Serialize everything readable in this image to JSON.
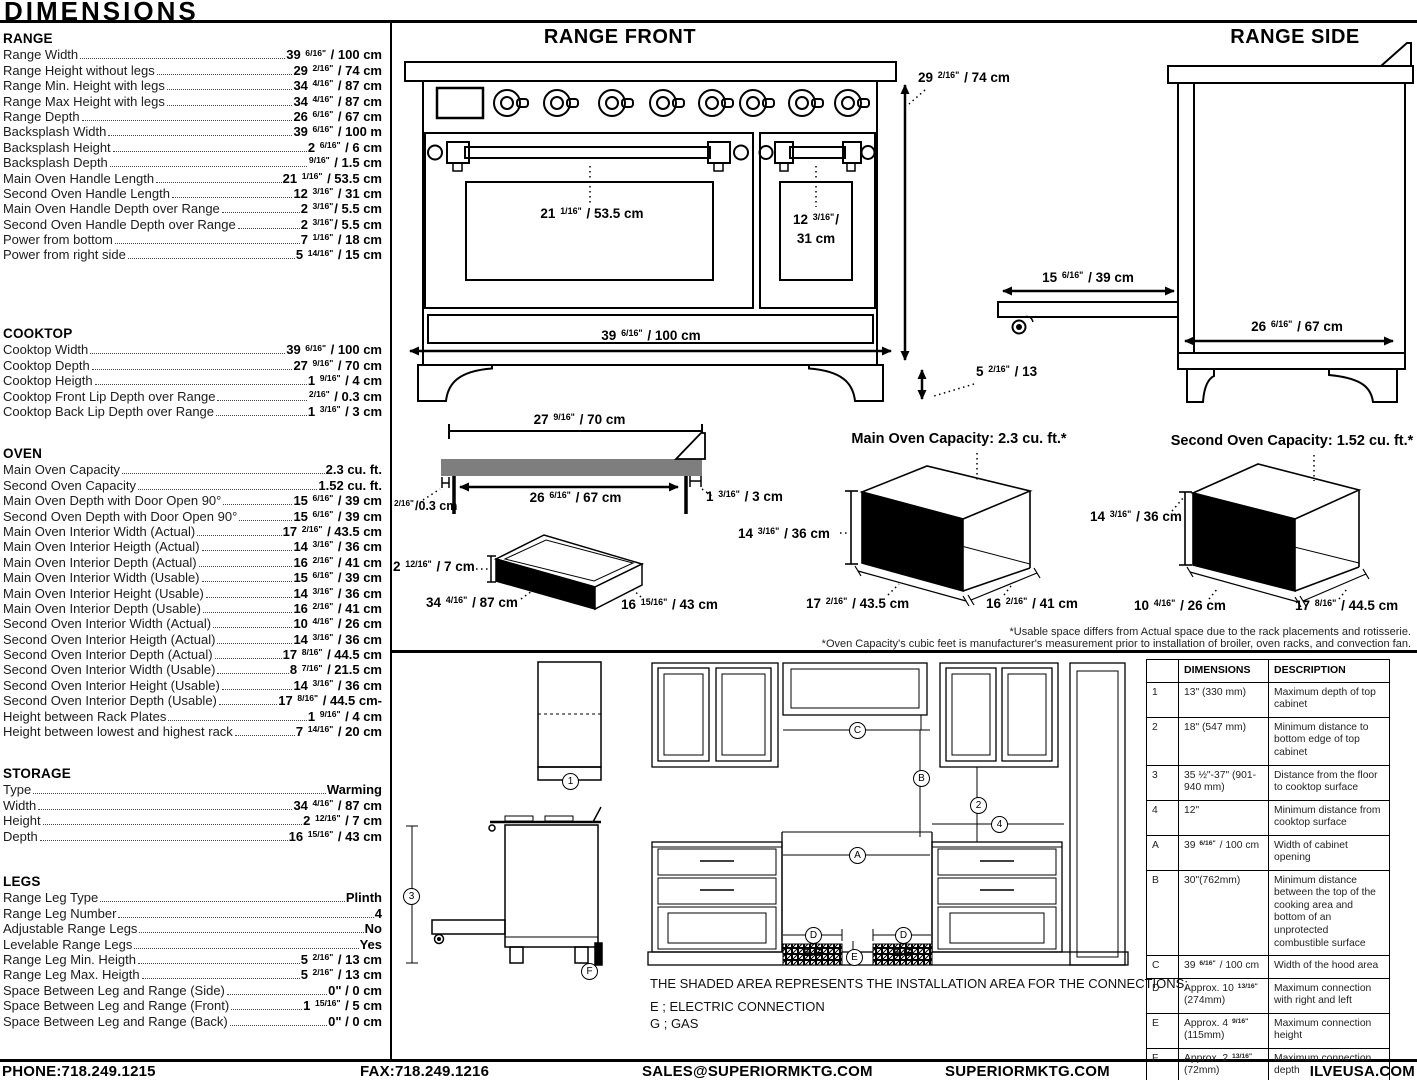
{
  "page": {
    "title": "DIMENSIONS"
  },
  "specs": [
    {
      "title": "RANGE",
      "items": [
        {
          "label": "Range Width",
          "value": "39 6/16\" / 100 cm"
        },
        {
          "label": "Range Height without legs",
          "value": "29 2/16\" / 74 cm"
        },
        {
          "label": "Range Min. Height with legs",
          "value": "34 4/16\" / 87 cm"
        },
        {
          "label": "Range Max Height with legs",
          "value": "34 4/16\" / 87 cm"
        },
        {
          "label": "Range Depth",
          "value": "26 6/16\" / 67 cm"
        },
        {
          "label": "Backsplash Width",
          "value": "39 6/16\" / 100 m"
        },
        {
          "label": "Backsplash Height",
          "value": "2 6/16\" / 6 cm"
        },
        {
          "label": "Backsplash Depth",
          "value": "9/16\" / 1.5 cm"
        },
        {
          "label": "Main Oven Handle Length",
          "value": "21 1/16\" / 53.5 cm"
        },
        {
          "label": "Second Oven Handle Length",
          "value": "12 3/16\" / 31 cm"
        },
        {
          "label": "Main Oven Handle Depth over Range",
          "value": "2 3/16\"/ 5.5 cm"
        },
        {
          "label": "Second Oven Handle Depth over Range",
          "value": "2 3/16\"/ 5.5 cm"
        },
        {
          "label": "Power from bottom",
          "value": "7 1/16\" / 18 cm"
        },
        {
          "label": "Power from right side",
          "value": "5 14/16\" / 15 cm"
        }
      ]
    },
    {
      "title": "COOKTOP",
      "items": [
        {
          "label": "Cooktop Width",
          "value": "39 6/16\" / 100 cm"
        },
        {
          "label": "Cooktop Depth",
          "value": "27 9/16\" / 70 cm"
        },
        {
          "label": "Cooktop Heigth",
          "value": "1 9/16\" / 4 cm"
        },
        {
          "label": "Cooktop Front Lip Depth over Range",
          "value": "2/16\" / 0.3 cm"
        },
        {
          "label": "Cooktop Back Lip Depth over Range",
          "value": "1 3/16\" / 3 cm"
        }
      ]
    },
    {
      "title": "OVEN",
      "items": [
        {
          "label": "Main Oven Capacity",
          "value": "2.3 cu. ft."
        },
        {
          "label": "Second Oven Capacity",
          "value": "1.52 cu. ft."
        },
        {
          "label": "Main Oven Depth with Door Open 90°",
          "value": "15 6/16\" / 39 cm"
        },
        {
          "label": "Second Oven Depth with Door Open 90°",
          "value": "15 6/16\" / 39 cm"
        },
        {
          "label": "Main Oven Interior Width (Actual)",
          "value": "17 2/16\" / 43.5 cm"
        },
        {
          "label": "Main Oven Interior Heigth (Actual)",
          "value": "14 3/16\" / 36 cm"
        },
        {
          "label": "Main Oven Interior Depth (Actual)",
          "value": "16 2/16\" / 41 cm"
        },
        {
          "label": "Main Oven Interior Width (Usable)",
          "value": "15 6/16\" / 39 cm"
        },
        {
          "label": "Main Oven Interior Height (Usable)",
          "value": "14 3/16\" / 36 cm"
        },
        {
          "label": "Main Oven Interior Depth (Usable)",
          "value": "16 2/16\" / 41 cm"
        },
        {
          "label": "Second Oven Interior Width (Actual)",
          "value": "10 4/16\" / 26 cm"
        },
        {
          "label": "Second Oven Interior Heigth (Actual)",
          "value": "14 3/16\" / 36 cm"
        },
        {
          "label": "Second Oven Interior Depth (Actual)",
          "value": "17 8/16\" / 44.5 cm"
        },
        {
          "label": "Second Oven Interior Width (Usable)",
          "value": "8 7/16\" / 21.5 cm"
        },
        {
          "label": "Second Oven Interior Height (Usable)",
          "value": "14 3/16\" / 36 cm"
        },
        {
          "label": "Second Oven Interior Depth (Usable)",
          "value": "17 8/16\" / 44.5 cm-"
        },
        {
          "label": "Height between Rack Plates",
          "value": "1 9/16\" / 4 cm"
        },
        {
          "label": "Height between lowest and highest rack",
          "value": "7 14/16\" / 20 cm"
        }
      ]
    },
    {
      "title": "STORAGE",
      "items": [
        {
          "label": "Type",
          "value": "Warming"
        },
        {
          "label": "Width",
          "value": "34 4/16\" / 87 cm"
        },
        {
          "label": "Height",
          "value": "2 12/16\" / 7 cm"
        },
        {
          "label": "Depth",
          "value": "16 15/16\" / 43 cm"
        }
      ]
    },
    {
      "title": "LEGS",
      "items": [
        {
          "label": "Range Leg Type",
          "value": "Plinth"
        },
        {
          "label": "Range Leg Number",
          "value": "4"
        },
        {
          "label": "Adjustable Range Legs",
          "value": "No"
        },
        {
          "label": "Levelable Range Legs",
          "value": "Yes"
        },
        {
          "label": "Range Leg Min. Heigth",
          "value": "5 2/16\" / 13 cm"
        },
        {
          "label": "Range Leg Max. Heigth",
          "value": "5 2/16\" / 13 cm"
        },
        {
          "label": "Space Between Leg and Range (Side)",
          "value": "0\" / 0 cm"
        },
        {
          "label": "Space Between Leg and Range (Front)",
          "value": "1 15/16\" / 5 cm"
        },
        {
          "label": "Space Between Leg and Range (Back)",
          "value": "0\" / 0 cm"
        }
      ]
    }
  ],
  "front": {
    "title": "RANGE FRONT",
    "main_door": "21 1/16\" / 53.5 cm",
    "second_door_1": "12 3/16\"/",
    "second_door_2": "31 cm",
    "width": "39 6/16\" / 100 cm",
    "height": "29 2/16\" / 74 cm",
    "legs": "5 2/16\" / 13"
  },
  "side": {
    "title": "RANGE SIDE",
    "door_open": "15 6/16\" / 39 cm",
    "depth": "26 6/16\" / 67 cm"
  },
  "cooktop_profile": {
    "width_top": "27 9/16\" / 70 cm",
    "width_bottom": "26 6/16\" / 67 cm",
    "front_lip": "2/16\"/0.3 cm",
    "back_lip": "1 3/16\" / 3 cm"
  },
  "storage_box": {
    "height": "2 12/16\" / 7 cm",
    "width": "34 4/16\" / 87 cm",
    "depth": "16 15/16\" / 43 cm"
  },
  "main_oven_box": {
    "title": "Main Oven Capacity: 2.3 cu. ft.*",
    "height": "14 3/16\" / 36 cm",
    "width": "17 2/16\" / 43.5 cm",
    "depth": "16 2/16\" / 41 cm"
  },
  "second_oven_box": {
    "title": "Second Oven Capacity: 1.52 cu. ft.*",
    "height": "14 3/16\" / 36 cm",
    "width": "10 4/16\" / 26 cm",
    "depth": "17 8/16\" / 44.5 cm"
  },
  "footnotes": {
    "line1": "*Usable space differs from Actual space due to the rack placements and rotisserie.",
    "line2": "*Oven Capacity's cubic feet is manufacturer's measurement prior to installation of broiler, oven racks, and convection fan."
  },
  "install": {
    "markers": {
      "n1": "1",
      "n2": "2",
      "n3": "3",
      "n4": "4",
      "a": "A",
      "b": "B",
      "c": "C",
      "d": "D",
      "e": "E",
      "f": "F"
    },
    "eg": "E.G",
    "note1": "THE SHADED AREA REPRESENTS THE INSTALLATION AREA FOR THE CONNECTIONS;",
    "note2": "E ; ELECTRIC CONNECTION",
    "note3": "G ; GAS"
  },
  "table": {
    "headers": [
      "",
      "DIMENSIONS",
      "DESCRIPTION"
    ],
    "rows": [
      {
        "id": "1",
        "dim": "13\" (330 mm)",
        "desc": "Maximum depth of top cabinet"
      },
      {
        "id": "2",
        "dim": "18\" (547 mm)",
        "desc": "Minimum distance to bottom edge of top cabinet"
      },
      {
        "id": "3",
        "dim": "35 ½\"-37\" (901-940 mm)",
        "desc": "Distance from the floor to cooktop surface"
      },
      {
        "id": "4",
        "dim": "12\"",
        "desc": "Minimum distance from cooktop surface"
      },
      {
        "id": "A",
        "dim": "39 6/16\" / 100 cm",
        "desc": "Width of cabinet opening"
      },
      {
        "id": "B",
        "dim": "30\"(762mm)",
        "desc": "Minimum distance between the top of the cooking area and bottom of an unprotected combustible surface"
      },
      {
        "id": "C",
        "dim": "39 6/16\" / 100 cm",
        "desc": "Width of the hood area"
      },
      {
        "id": "D",
        "dim": "Approx. 10 13/16\" (274mm)",
        "desc": "Maximum connection with right and left"
      },
      {
        "id": "E",
        "dim": "Approx. 4 9/16\" (115mm)",
        "desc": "Maximum connection height"
      },
      {
        "id": "F",
        "dim": "Approx. 2 13/16\" (72mm)",
        "desc": "Maximum connection depth"
      }
    ]
  },
  "footer": {
    "phone": "PHONE:718.249.1215",
    "fax": "FAX:718.249.1216",
    "email": "SALES@SUPERIORMKTG.COM",
    "website": "SUPERIORMKTG.COM",
    "website2": "ILVEUSA.COM"
  }
}
